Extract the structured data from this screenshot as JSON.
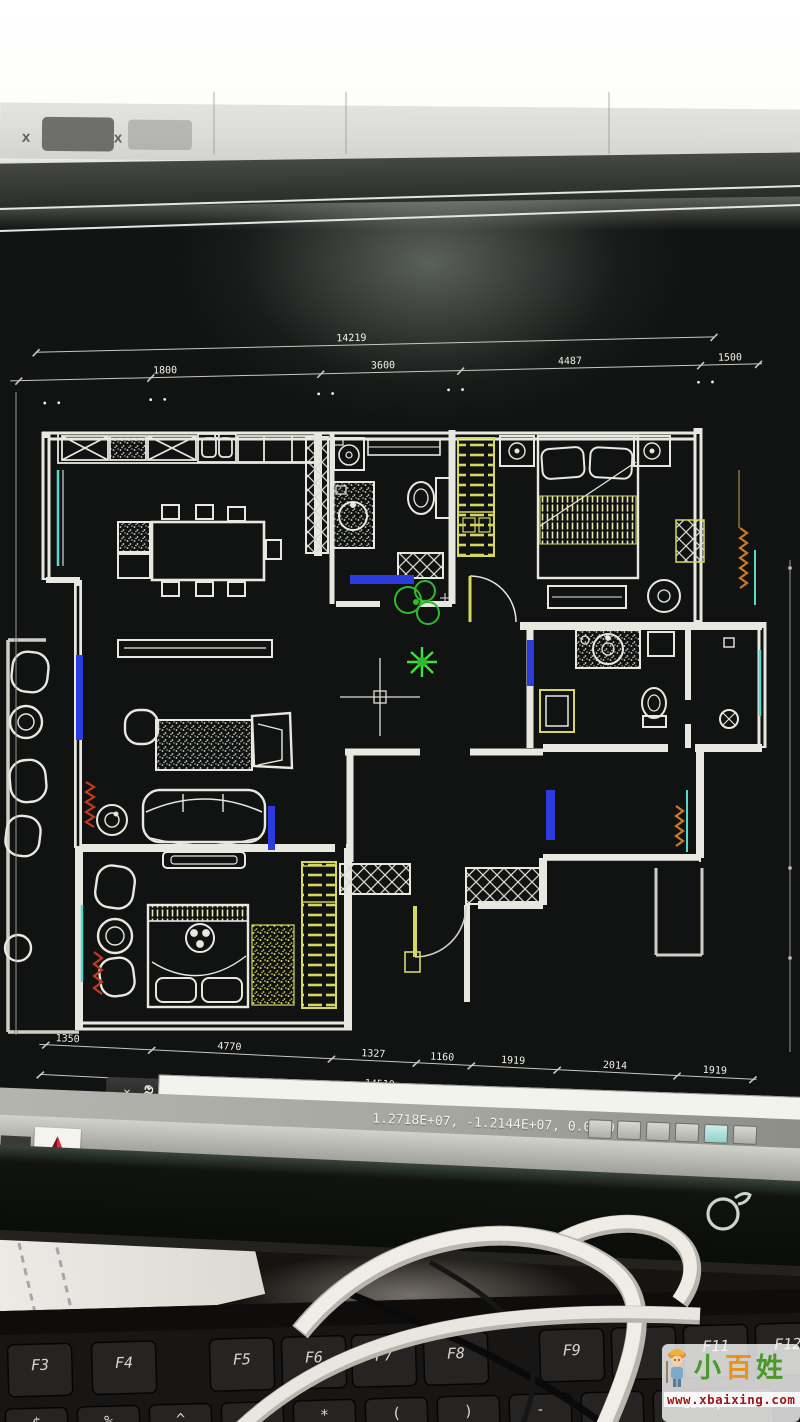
{
  "scene": {
    "description": "Photograph of a desktop monitor showing a CAD apartment floor-plan (white lines on black), with a black keyboard below and white cables in front",
    "window_close_icons": [
      "x",
      "x"
    ]
  },
  "cad_app": {
    "canvas_color": "#101311",
    "command_bar": {
      "close_icon": "×",
      "input_value": ""
    },
    "status_bar": {
      "coordinates": "1.2718E+07, -1.2144E+07, 0.0000",
      "toggle_count": 6
    },
    "taskbar": {
      "app_logo": "autocad-red-triangle"
    }
  },
  "floor_plan": {
    "line_colors": {
      "walls": "#e8e8e0",
      "wardrobe_yellow": "#d6d75e",
      "window_blue": "#2b3bdd",
      "glazing_teal": "#57d8cc",
      "plant_green": "#2fbb2f",
      "plant_bright_green": "#3ee23e",
      "radiator_red": "#c23b1e",
      "radiator_orange": "#c87a28"
    },
    "dimensions": {
      "top_overall": "14219",
      "top_segments": [
        "1800",
        "3600",
        "4487",
        "1500"
      ],
      "bottom_segments": [
        "1350",
        "4770",
        "1327",
        "1160",
        "1919",
        "2014",
        "1919"
      ],
      "bottom_overall": "14519"
    }
  },
  "monitor": {
    "power_icon": "power-swoosh"
  },
  "keyboard": {
    "fkeys": [
      "F3",
      "F4",
      "F5",
      "F6",
      "F7",
      "F8",
      "F9",
      "F11",
      "F12"
    ],
    "symbols": [
      "$",
      "%",
      "^",
      "&",
      "*",
      "(",
      ")",
      "-",
      "+"
    ],
    "backspace": "BackSpace"
  },
  "watermark": {
    "brand_chars": [
      {
        "char": "小",
        "color": "#4a9a28"
      },
      {
        "char": "百",
        "color": "#e8941c"
      },
      {
        "char": "姓",
        "color": "#4a9a28"
      }
    ],
    "url": "www.xbaixing.com"
  }
}
